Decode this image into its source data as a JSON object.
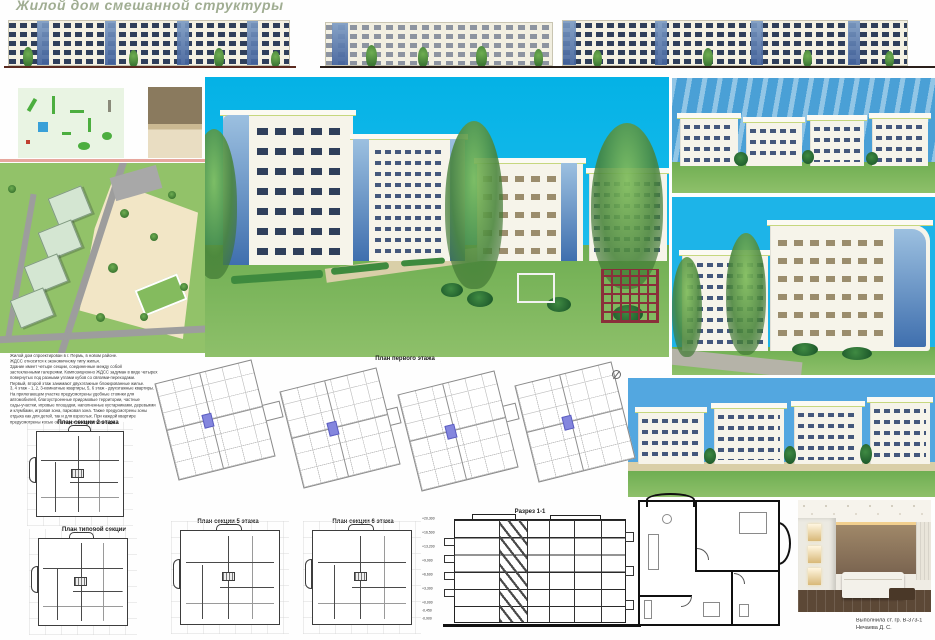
{
  "title": "Жилой дом смешанной структуры",
  "description": "Жилой дом спроектирован в г. Пермь, в новом районе.\nЖДСС относится к экономичному типу жилья.\nЗдание имеет четыре секции, соединенные между собой\nзастекленными галереями. Композиционно ЖДСС задуман в виде четырех\nповернутых под разными углами кубов со связями-переходами.\nПервый, второй этаж занимают двухэтажные блокированные жилье.\n3, 4 этаж - 1, 2, 3-комнатные квартиры, 5, 6 этаж - двухэтажные квартиры.\nНа прилегающем участке предусмотрены удобные стоянки для\nавтомобилей, благоустроенные придомовые территории, частные\nсады-участки, игровые площадки, наполненные кустарниками, деревьями\nи клумбами, игровая зона, парковая зона. Также предусмотрены зоны\nотдыха как для детей, так и для взрослых. При каждой квартире\nпредусмотрены косые окна-террасы или летние сады.",
  "plans": {
    "first_floor": "План первого этажа",
    "section2": "План секции 2 этажа",
    "typical": "План типовой секции",
    "section5": "План секции 5 этажа",
    "section6": "План секции 6 этажа",
    "razrez": "Разрез 1-1"
  },
  "section_levels": [
    "+20,300",
    "+16,500",
    "+13,200",
    "+9,900",
    "+6,600",
    "+3,300",
    "+0,000",
    "-0,450",
    "-0,900"
  ],
  "credit": {
    "line1": "Выполнила ст. гр. В-373-1",
    "line2": "Нечаева Д. С."
  },
  "colors": {
    "title_green": "#a0ad92",
    "sky_cyan": "#0cb4e6",
    "sky_blue": "#4aa0d8",
    "lawn_green": "#7ab457",
    "wall_cream": "#f4f1e3",
    "window_blue": "#2f3f5b",
    "glass_blue": "#5d83b8",
    "core_purple": "#8486de",
    "sand_beige": "#f2e6c6"
  }
}
